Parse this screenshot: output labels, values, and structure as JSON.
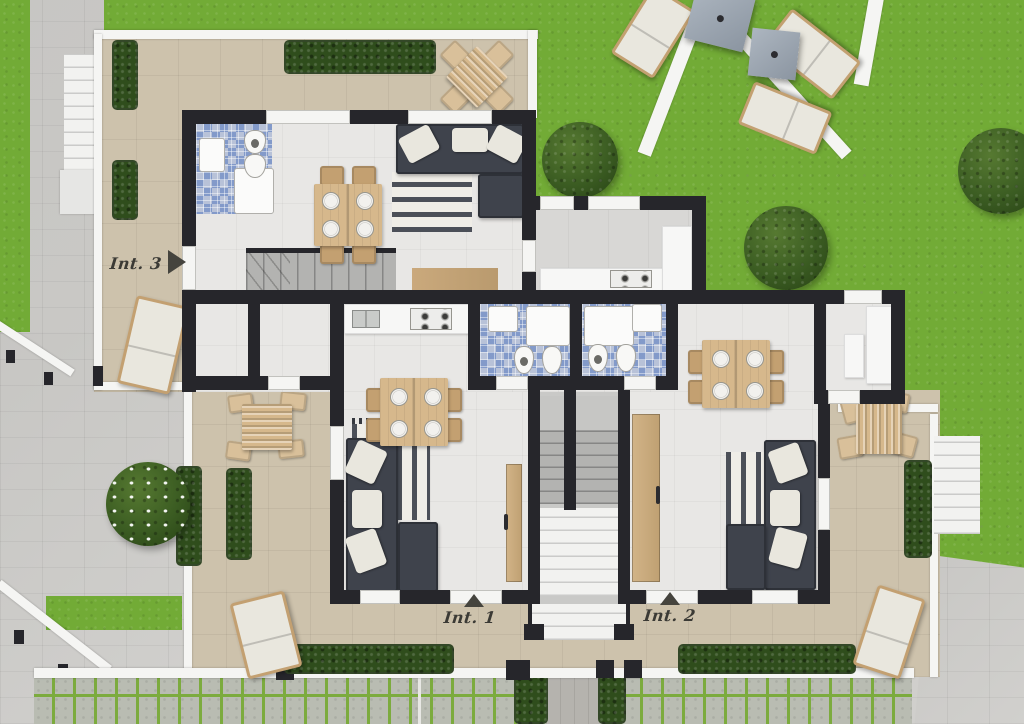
{
  "plan": {
    "units": [
      {
        "id": "int-1",
        "label": "Int. 1",
        "marker": "triangle-up"
      },
      {
        "id": "int-2",
        "label": "Int. 2",
        "marker": "triangle-up"
      },
      {
        "id": "int-3",
        "label": "Int. 3",
        "marker": "triangle-right"
      }
    ],
    "rooms": [
      "kitchen",
      "bathroom",
      "living-room",
      "dining-area",
      "terrace",
      "stairwell"
    ],
    "outdoor": [
      "lawn",
      "sun-loungers",
      "parasols",
      "garden-paths",
      "hedges",
      "trees",
      "grass-paver-driveway"
    ]
  },
  "theme": {
    "grass": "#72ab36",
    "paving": "#cfcecb",
    "paving-dark": "#b5b3ae",
    "terrace": "#cdc2ac",
    "floor": "#e8e7e5",
    "floor-wing": "#d8d7d5",
    "wall": "#26262b",
    "white": "#f5f5f3",
    "mosaic": "#a8b5cf",
    "mosaic-dark": "#5d7fc4",
    "wood": "#d6b88c",
    "wood-dark": "#c3a071",
    "sofa": "#3f434c",
    "cushion": "#e9e7de",
    "rug-dark": "#4b4f58",
    "hedge": "#2f4d1c",
    "steps": "#f2f2f0",
    "steps-gray": "#b3b3b1",
    "label": "#3b3a35",
    "umbrella": "#99a3ae",
    "paver": "#b9bcb2",
    "paver-joint": "#7cab3e",
    "counter": "#f7f7f6"
  }
}
